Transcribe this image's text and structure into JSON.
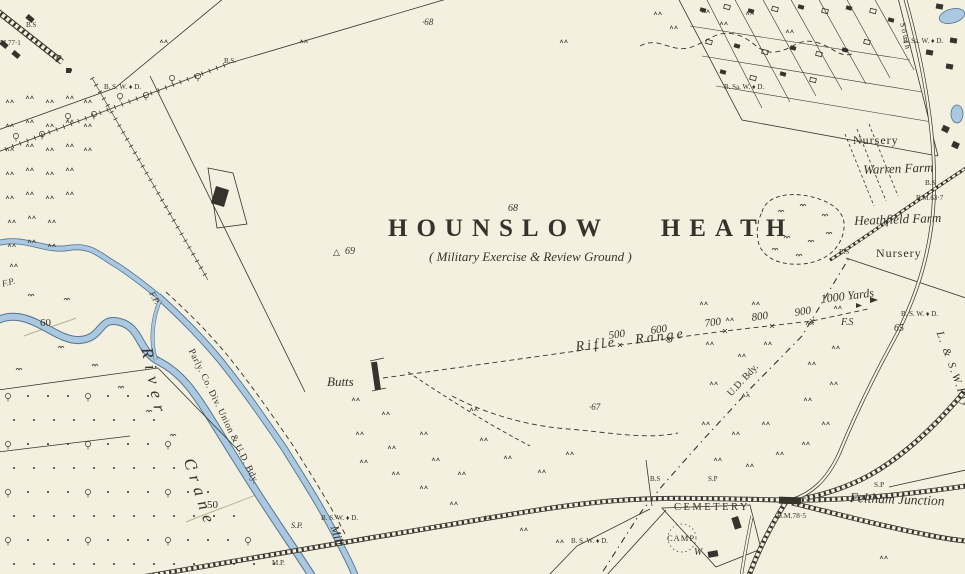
{
  "map": {
    "name": "Ordnance Survey county series sheet — Hounslow Heath",
    "colors": {
      "paper": "#f3f0df",
      "ink": "#35332c",
      "water": "#abc8e1",
      "wedge": "#54748f",
      "contour": "#b9b093"
    },
    "labels": {
      "title": "HOUNSLOW HEATH",
      "title_altitude": "68",
      "subtitle": "( Military Exercise & Review Ground )",
      "spot_68": "·68",
      "trig_symbol": "△",
      "trig_69": "69",
      "spot_67": "·67",
      "butts": "Butts",
      "rifle_range": "Rifle Range",
      "yd_500": "500",
      "yd_600": "600",
      "yd_700": "700",
      "yd_800": "800",
      "yd_900": "900",
      "yd_1000": "1000 Yards",
      "fs": "F.S",
      "bm_65": "65",
      "bswd_range": "B. S. W. ♦ D.",
      "nursery_north": "Nursery",
      "warren_farm": "Warren Farm",
      "bs_warren": "B.S",
      "bm_63_7": "B.M.63·7",
      "heathfield_farm": "Heathfield Farm",
      "bs_heathfield": "B.S",
      "nursery_east": "Nursery",
      "ud_bdy": "U.D. Bdy.",
      "bs_rail": "B.S",
      "sp_rail": "S.P",
      "cemetery": "CEMETERY",
      "bm_78_5": "B.M.78·5",
      "camp": "CAMP",
      "well": "W",
      "bswd_camp": "B. S. W. ♦ D.",
      "feltham_junction": "Feltham Junction",
      "sp_junction": "S.P",
      "bsawd_allotments": "B. Sa. W. ♦ D.",
      "bsawd_corner": "B. Sa. W. ♦ D.",
      "bs_avenue": "B.S.",
      "bswd_avenue": "B. S. W. ♦ D.",
      "bs_nw": "B.S",
      "bm_77_1": "M.77·1",
      "pump": "P",
      "river_word": "River",
      "crane_word": "Crane",
      "parly_bdy": "Parly. Co. Div. Union & U.D. Bdy.",
      "contour_50": "50",
      "contour_60": "60",
      "fp_1": "F.P.",
      "fp_2": "F.P.",
      "mill": "Mill",
      "sp_west": "S.P.",
      "bswd_west": "B. S. W. ♦ D.",
      "mp_west": "M.P.",
      "lswr": "L. & S.W.Rly",
      "south_rly": "South"
    }
  }
}
